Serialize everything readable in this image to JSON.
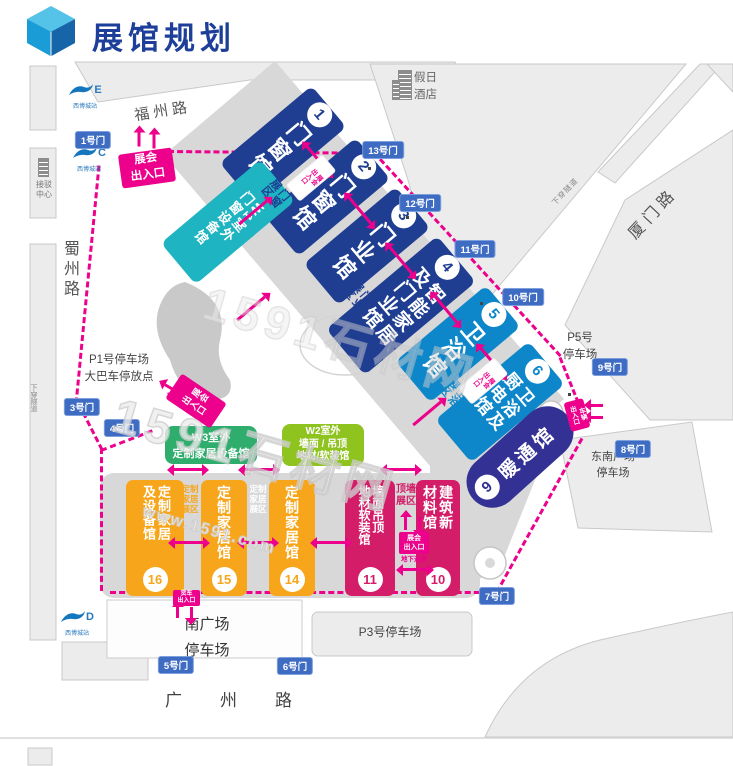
{
  "header": {
    "title": "展馆规划"
  },
  "roads": {
    "fuzhou": "福州路",
    "xiamen": "厦门路",
    "shuzhou": "蜀州路",
    "guangzhou": "广州路",
    "tunnel": "下穿隧道"
  },
  "landmarks": {
    "hotel": "假日\n酒店",
    "transfer": "接驳\n中心"
  },
  "metro": {
    "station": "西博城站",
    "exit_e": "E",
    "exit_c": "C",
    "exit_d": "D"
  },
  "gates": [
    "1号门",
    "3号门",
    "4号门",
    "5号门",
    "6号门",
    "7号门",
    "8号门",
    "9号门",
    "10号门",
    "11号门",
    "12号门",
    "13号门"
  ],
  "halls": [
    {
      "num": "1",
      "name": "门窗馆"
    },
    {
      "num": "2",
      "name": "门窗馆"
    },
    {
      "num": "3",
      "name": "门业馆"
    },
    {
      "num": "4",
      "name": "智能家居\n及门业馆"
    },
    {
      "num": "5",
      "name": "卫浴馆"
    },
    {
      "num": "6",
      "name": "卫浴及\n厨电馆"
    },
    {
      "num": "9",
      "name": "暖通馆"
    },
    {
      "num": "10",
      "name": "建筑新\n材料馆"
    },
    {
      "num": "11",
      "name": "墙面吊顶\n地材软装馆"
    },
    {
      "num": "14",
      "name": "定制家居馆"
    },
    {
      "num": "15",
      "name": "定制家居馆"
    },
    {
      "num": "16",
      "name": "定制家居\n及设备馆"
    }
  ],
  "outdoor_halls": {
    "w1": "W1室外\n门窗设备馆",
    "w3_line1": "W3室外",
    "w3_line2": "定制家居设备馆",
    "w2_line1": "W2室外",
    "w2_line2": "墙面 / 吊顶",
    "w2_line3": "地材/软装馆"
  },
  "zones": {
    "door_window": "门窗\n展区",
    "door": "门业\n展区",
    "bath": "卫浴\n展区",
    "custom1": "定制\n家居\n展区",
    "custom2": "定制\n家居\n展区",
    "ceiling": "顶墙\n展区"
  },
  "entrances": {
    "main": "展会\n出入口",
    "side": "展会\n出入口",
    "marker1": "展会\n出入口",
    "marker2": "展会\n出入口",
    "underpass": "展会\n出入口",
    "underpass_note": "地下通道",
    "truck": "货车\n出入口",
    "vehicle": "车辆\n出入口"
  },
  "parking": {
    "p1": "P1号停车场\n大巴车停放点",
    "p3": "P3号停车场",
    "p5": "P5号\n停车场",
    "southeast": "东南广场\n停车场",
    "south": "南广场\n停车场"
  },
  "watermark": {
    "brand": "1591石材网",
    "url": "www.1591.com"
  },
  "colors": {
    "title_blue": "#1d3f99",
    "hall_dark_blue": "#1f3e92",
    "hall_light_blue": "#0d87c9",
    "hall_hvac_indigo": "#333193",
    "hall_orange": "#f7a61b",
    "hall_magenta": "#d41d68",
    "outdoor_teal": "#1fb4c1",
    "outdoor_green": "#2fad6c",
    "outdoor_yellow_green": "#8fc320",
    "gate_blue": "#3e6cc3",
    "accent_magenta": "#ec008c",
    "band_gray": "#d8d8d8",
    "block_gray": "#ececec"
  }
}
